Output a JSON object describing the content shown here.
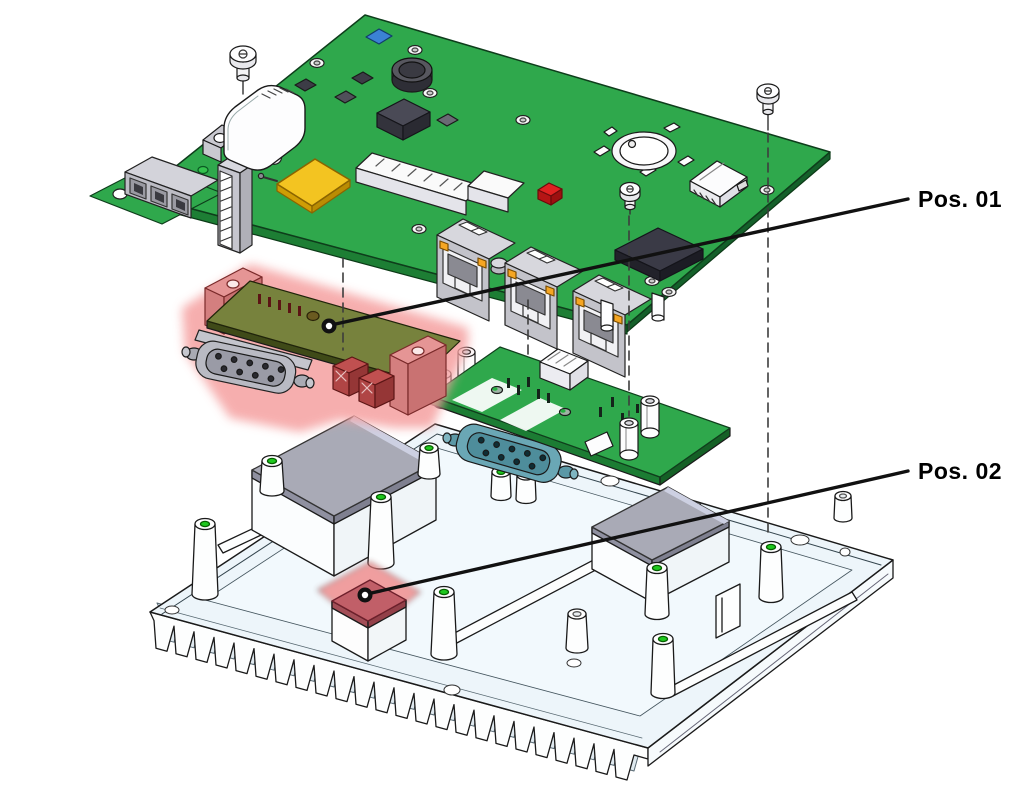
{
  "diagram": {
    "type": "exploded-assembly-technical-drawing",
    "background": "#ffffff",
    "callouts": {
      "pos01": {
        "label": "Pos. 01",
        "marked_part": "serial-interface-module"
      },
      "pos02": {
        "label": "Pos. 02",
        "marked_part": "thermal-pad-on-heatsink-boss"
      }
    },
    "parts": {
      "main_board": "carrier-board-pcb",
      "pos01_module": "serial-interface-module-highlighted",
      "daughter_board": "io-daughter-board",
      "heatsink": "heatsink-base-plate",
      "screws": "mounting-screws",
      "thermal_pads": "gray-thermal-pads",
      "pos02_pad": "red-thermal-pad"
    },
    "colors": {
      "pcb_green": "#2fa84c",
      "pcb_edge": "#1d7e34",
      "module_board": "#77823d",
      "highlight_glow": "#f5a0a0",
      "highlight_bracket": "#e59595",
      "terminal_red": "#b04545",
      "thermal_pad_gray": "#a9aab6",
      "thermal_pad_red": "#c15f68",
      "heatsink_face": "#edf5fa",
      "connector_gray": "#c3c3ca",
      "led_orange": "#f5a623",
      "pad_yellow": "#f3c421",
      "dsub_teal": "#6aa7b5",
      "jumper_red": "#e02222",
      "leader_line": "#111111"
    }
  }
}
